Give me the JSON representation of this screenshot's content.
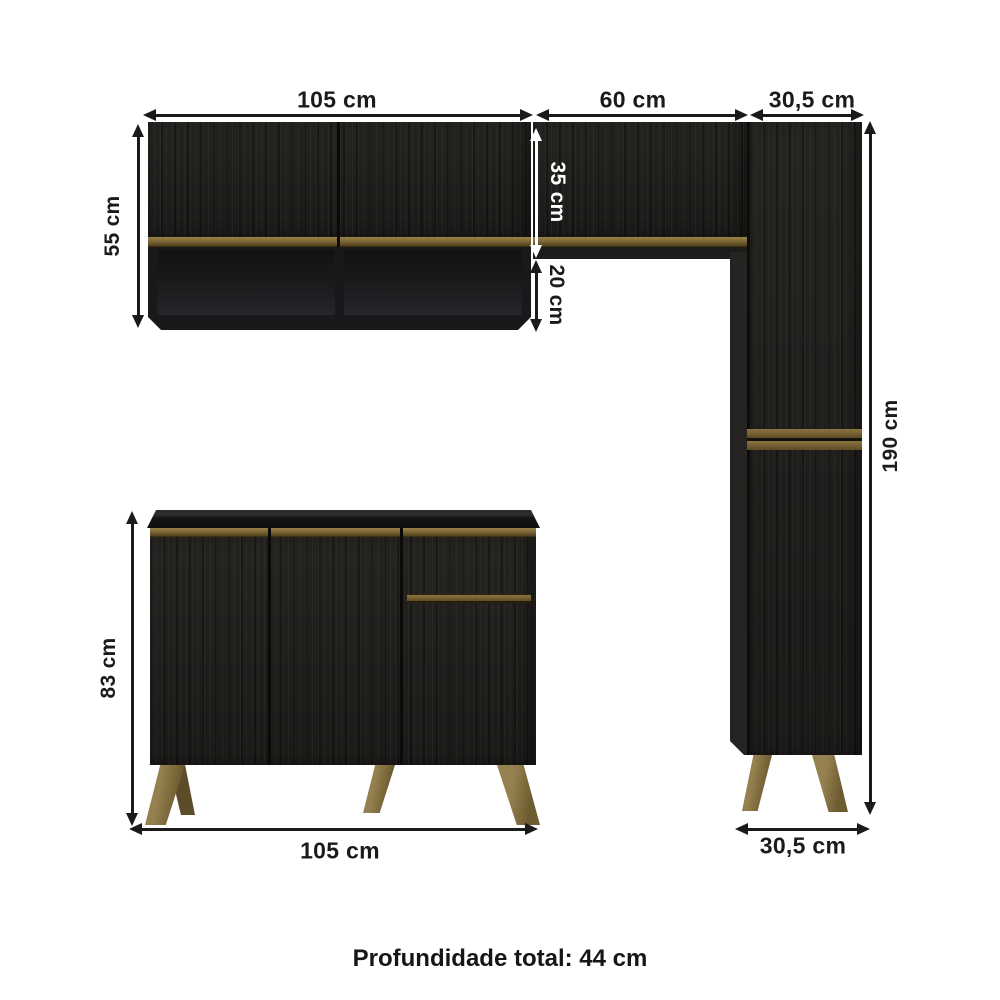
{
  "dimensions": {
    "upper_left_cabinet_width": "105 cm",
    "upper_middle_cabinet_width": "60 cm",
    "upper_right_cabinet_width": "30,5 cm",
    "upper_left_cabinet_height": "55 cm",
    "upper_door_height": "35 cm",
    "open_shelf_height": "20 cm",
    "tall_cabinet_height": "190 cm",
    "base_cabinet_height": "83 cm",
    "base_cabinet_width": "105 cm",
    "tall_cabinet_width_bottom": "30,5 cm"
  },
  "footer": {
    "text": "Profundidade total: 44 cm"
  },
  "colors": {
    "background": "#ffffff",
    "cabinet_body": "#201e1c",
    "accent_gold": "#7a6536",
    "leg_bronze": "#8a7547",
    "dimension_dark": "#1a1a1a",
    "dimension_light": "#ffffff"
  }
}
